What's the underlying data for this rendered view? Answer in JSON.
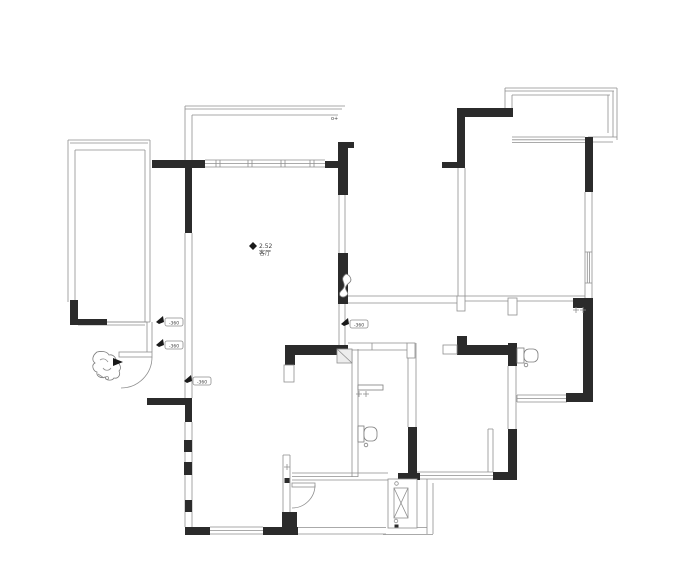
{
  "plan": {
    "colors": {
      "wall": "#2b2b2b",
      "line": "#8f8f8f",
      "text": "#3f3f3f",
      "paper": "#ffffff",
      "box_fill": "#ededed"
    },
    "annotations": {
      "level": {
        "value": "2.52",
        "label": "客厅"
      },
      "flags": [
        "-360",
        "-360",
        "-360",
        "-360"
      ],
      "corner_mark": "o+"
    }
  }
}
